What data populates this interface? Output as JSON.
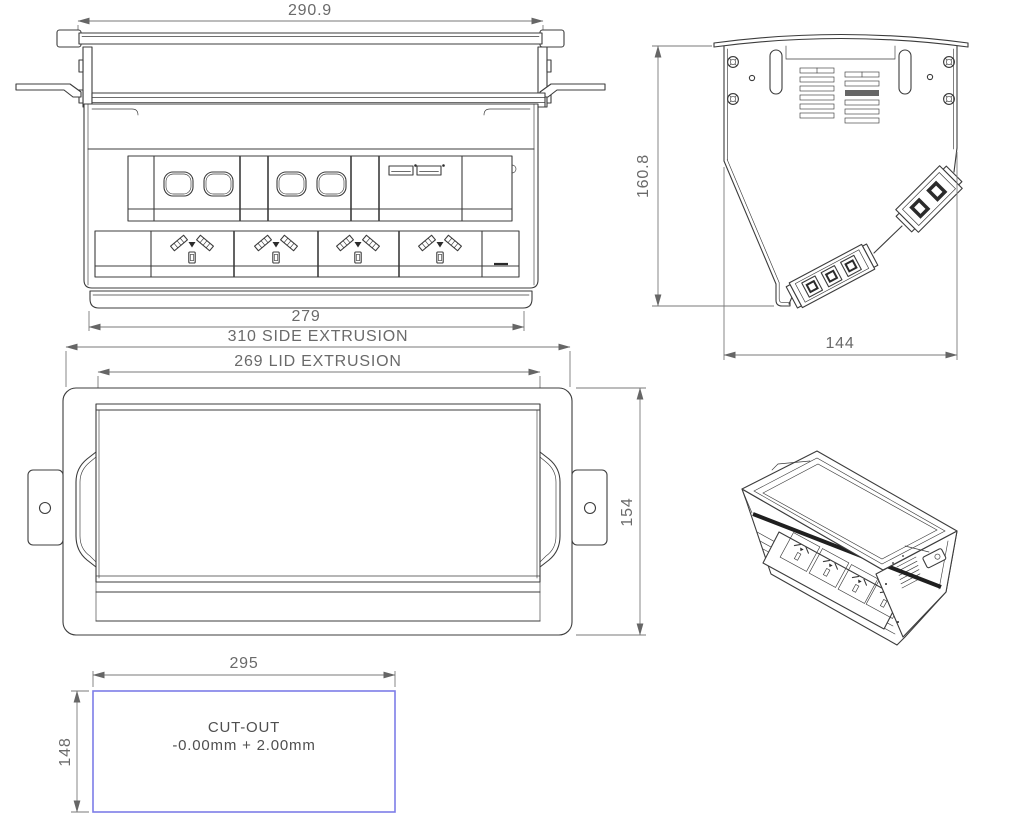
{
  "document": {
    "type": "technical-drawing",
    "subject": "pop-up desk power module"
  },
  "views": {
    "front": {
      "label": "front-view-open",
      "dim_top": "290.9",
      "dim_bottom": "279"
    },
    "side": {
      "label": "side-section-view",
      "dim_height": "160.8",
      "dim_width": "144"
    },
    "plan": {
      "label": "plan-view-closed",
      "dim_side_extrusion": "310 SIDE EXTRUSION",
      "dim_lid_extrusion": "269 LID EXTRUSION",
      "dim_height": "154"
    },
    "cutout": {
      "label": "cutout-template",
      "dim_width": "295",
      "dim_height": "148",
      "title": "CUT-OUT",
      "tolerance": "-0.00mm + 2.00mm"
    },
    "iso": {
      "label": "isometric-view"
    }
  },
  "colors": {
    "line": "#3c3c3c",
    "dimension": "#7a7a7a",
    "dimension_text": "#6a6a6a",
    "cutout_outline": "#7d7de8",
    "background": "#ffffff"
  }
}
